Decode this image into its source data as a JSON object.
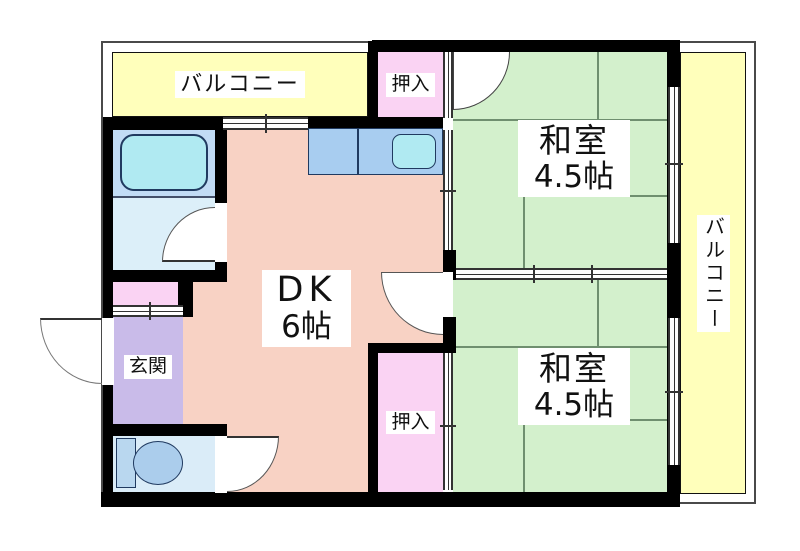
{
  "title": "apartment floor plan",
  "rooms": {
    "balcony_top": {
      "label": "バルコニー"
    },
    "balcony_right": {
      "label": "バルコニー"
    },
    "closet_top": {
      "label": "押入"
    },
    "closet_bottom": {
      "label": "押入"
    },
    "japanese_room_top": {
      "name": "和室",
      "size": "4.5帖"
    },
    "japanese_room_bottom": {
      "name": "和室",
      "size": "4.5帖"
    },
    "dining_kitchen": {
      "name": "DK",
      "size": "6帖"
    },
    "entrance": {
      "label": "玄関"
    }
  },
  "fixtures": {
    "bathtub": "bathtub",
    "kitchen_sink": "kitchen-sink",
    "toilet": "toilet"
  },
  "colors": {
    "balcony": "#ffffbb",
    "tatami_room": "#d3f0cc",
    "tatami_line": "#6f8f6f",
    "dining_kitchen": "#f8d2c4",
    "closet": "#fad3f3",
    "entrance": "#c9bbe9",
    "bath_zone": "#c2dcf5",
    "washroom": "#dceff9",
    "toilet_room": "#daecf8",
    "fixture_fill": "#b0eaf2",
    "counter_fill": "#a8cdf0",
    "wall": "#000000"
  }
}
